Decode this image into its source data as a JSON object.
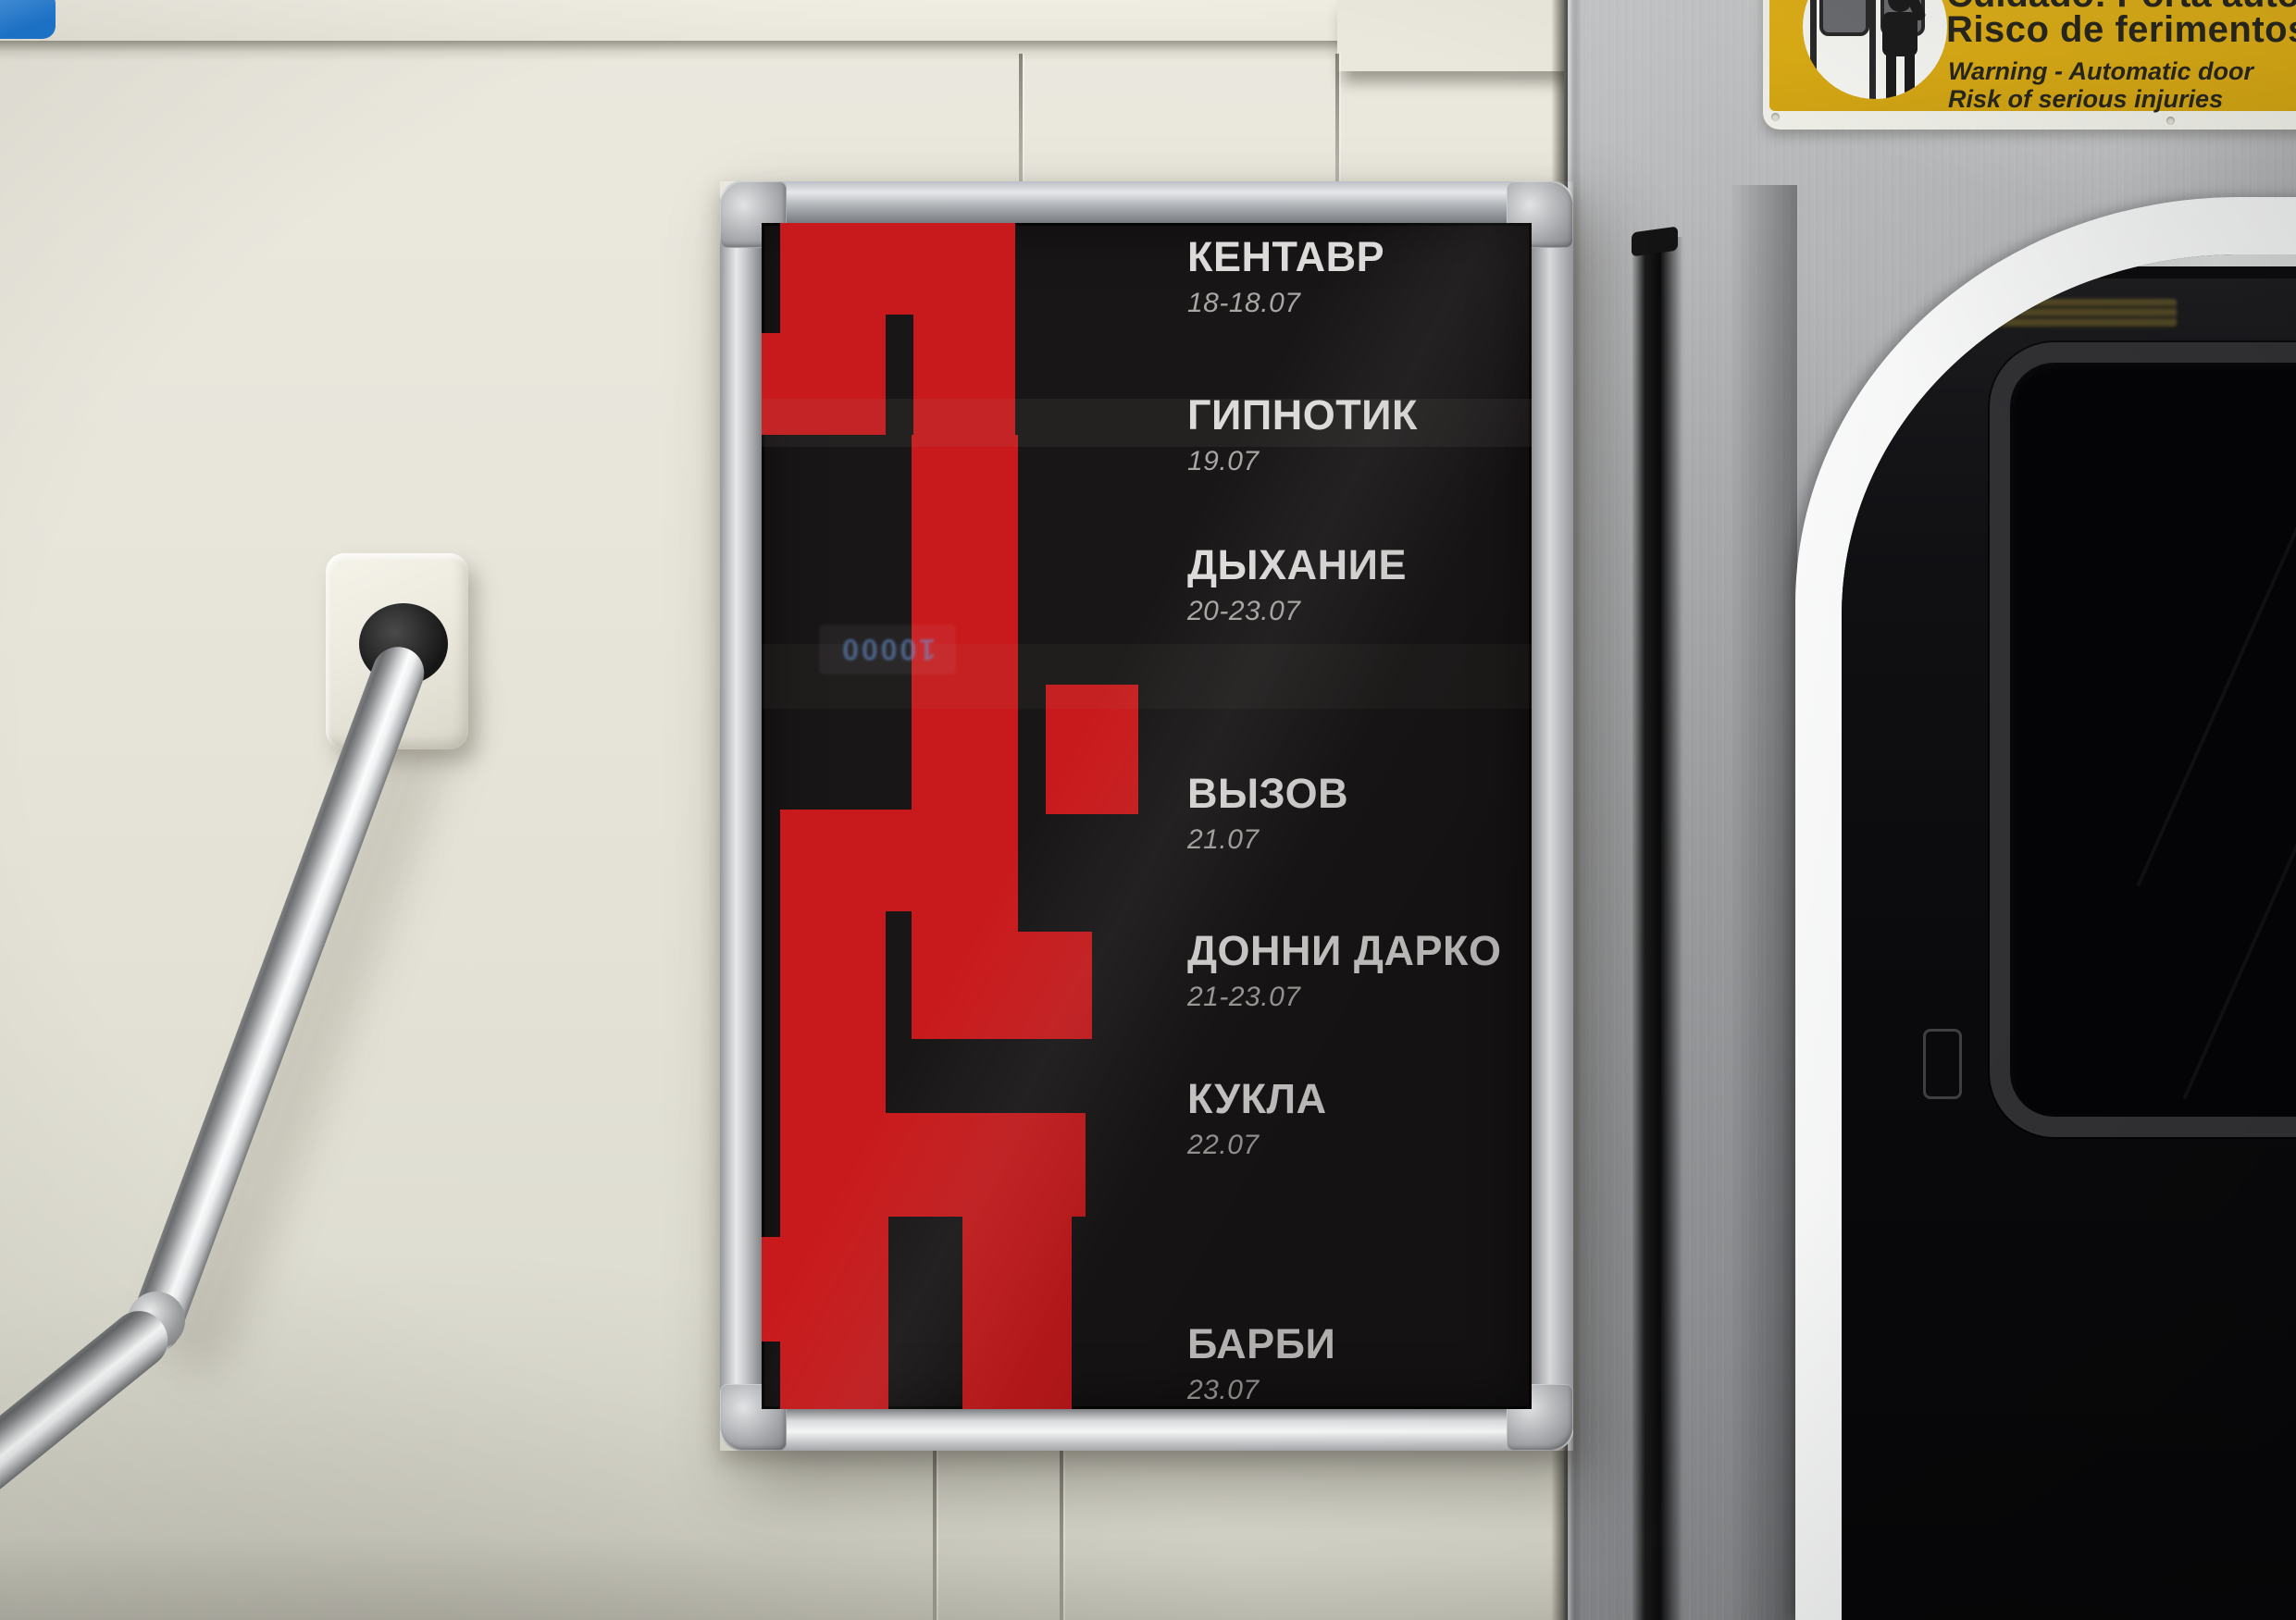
{
  "scene": {
    "description": "Metro train interior wall with framed film schedule poster, chrome handrail and automatic door"
  },
  "poster": {
    "entries": [
      {
        "title": "КЕНТАВР",
        "date": "18-18.07"
      },
      {
        "title": "ГИПНОТИК",
        "date": "19.07"
      },
      {
        "title": "ДЫХАНИЕ",
        "date": "20-23.07"
      },
      {
        "title": "ВЫЗОВ",
        "date": "21.07"
      },
      {
        "title": "ДОННИ ДАРКО",
        "date": "21-23.07"
      },
      {
        "title": "КУКЛА",
        "date": "22.07"
      },
      {
        "title": "БАРБИ",
        "date": "23.07"
      }
    ],
    "colors": {
      "red": "#c81a1c",
      "background": "#191617",
      "title_text": "#dcdbd9",
      "date_text": "#a8a6a3"
    }
  },
  "glass_reflection": {
    "text": "10000"
  },
  "warning_sticker": {
    "line1": "Cuidado! Porta automática",
    "line2": "Risco de ferimentos",
    "line3": "Warning - Automatic door",
    "line4": "Risk of serious injuries",
    "colors": {
      "background": "#dcad16",
      "text": "#28271f"
    }
  }
}
